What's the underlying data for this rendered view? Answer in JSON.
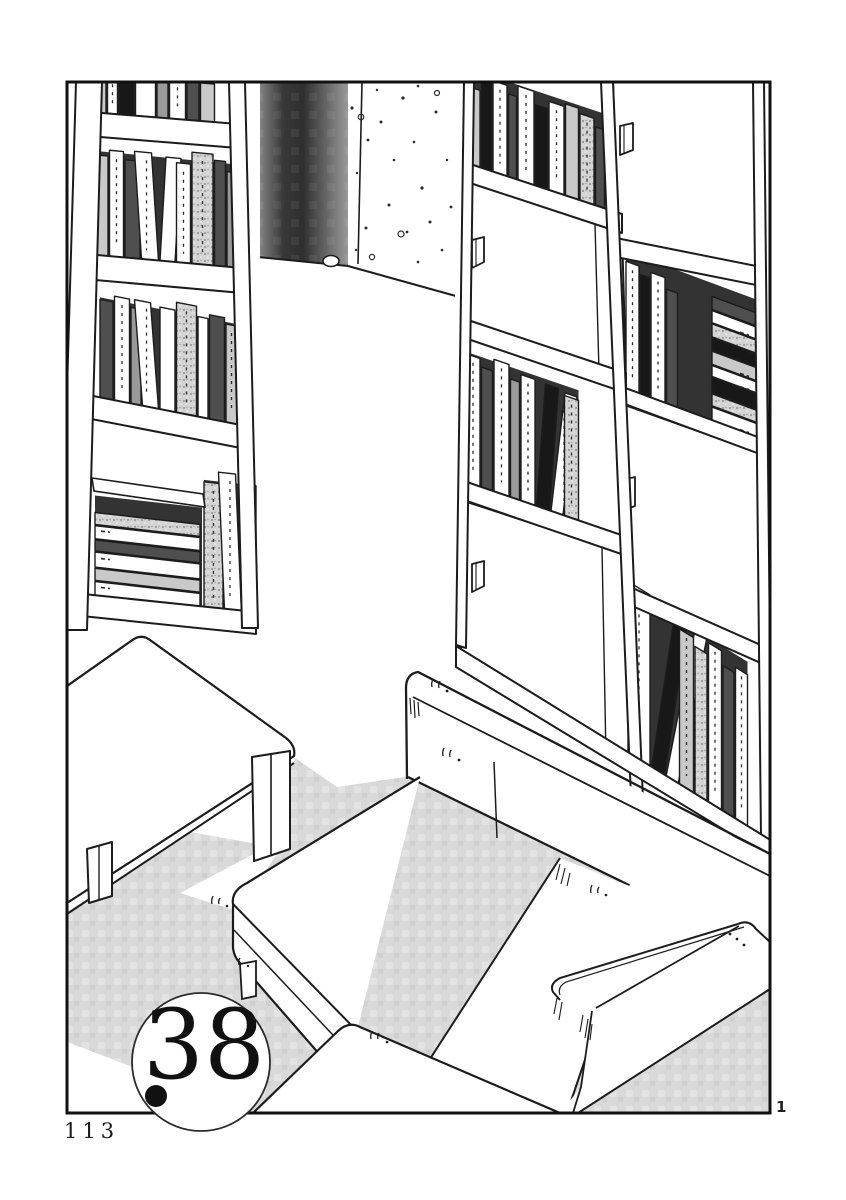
{
  "page": {
    "page_number": "113",
    "panel_number": "1",
    "chapter_badge": "38"
  },
  "colors": {
    "ink": "#1c1c1c",
    "paper": "#ffffff",
    "screentone": "#d9d9d9",
    "wall_shadow_dark": "#2f2f2f",
    "book_dark": "#181818",
    "book_gray": "#c9c9c9"
  },
  "scene": {
    "left_shelf": {
      "rows": [
        {
          "bx": 92,
          "by": 112,
          "slope": 0.082,
          "x": 94,
          "shadow": 46,
          "books": [
            [
              12,
              40,
              "lg",
              0,
              ""
            ],
            [
              10,
              46,
              "w",
              0,
              "m"
            ],
            [
              15,
              42,
              "bk",
              0,
              ""
            ],
            [
              20,
              38,
              "w",
              0,
              ""
            ],
            [
              11,
              44,
              "mg",
              0,
              ""
            ],
            [
              16,
              40,
              "w",
              0,
              "m"
            ],
            [
              12,
              46,
              "dg",
              0,
              ""
            ],
            [
              14,
              38,
              "lg",
              0,
              ""
            ]
          ]
        },
        {
          "bx": 86,
          "by": 254,
          "slope": 0.096,
          "x": 96,
          "shadow": 104,
          "books": [
            [
              12,
              100,
              "lg",
              0,
              ""
            ],
            [
              14,
              106,
              "w",
              0,
              "m"
            ],
            [
              15,
              98,
              "dg",
              0,
              ""
            ],
            [
              17,
              108,
              "w",
              -7,
              "m"
            ],
            [
              15,
              104,
              "w",
              6,
              ""
            ],
            [
              14,
              100,
              "w",
              0,
              "m"
            ],
            [
              21,
              112,
              "tx",
              0,
              "m"
            ],
            [
              11,
              106,
              "dg",
              0,
              ""
            ],
            [
              10,
              96,
              "mg",
              0,
              ""
            ]
          ]
        },
        {
          "bx": 83,
          "by": 394,
          "slope": 0.196,
          "x": 100,
          "shadow": 100,
          "books": [
            [
              13,
              98,
              "dg",
              0,
              ""
            ],
            [
              15,
              104,
              "w",
              0,
              "m"
            ],
            [
              10,
              96,
              "mg",
              0,
              ""
            ],
            [
              16,
              106,
              "w",
              -8,
              "m"
            ],
            [
              15,
              102,
              "w",
              0,
              ""
            ],
            [
              20,
              110,
              "tx",
              0,
              "m"
            ],
            [
              10,
              100,
              "w",
              0,
              ""
            ],
            [
              15,
              104,
              "dg",
              0,
              ""
            ],
            [
              11,
              98,
              "lg",
              0,
              "m"
            ]
          ]
        },
        {
          "bx": 64,
          "by": 592,
          "slope": 0.113,
          "x": 66,
          "shadow": 0,
          "books": [
            [
              13,
              122,
              "bk",
              0,
              ""
            ]
          ]
        },
        {
          "bx": 64,
          "by": 592,
          "slope": 0.113,
          "x": 95,
          "span": 107,
          "shadow": 100,
          "books": []
        },
        {
          "bx": 64,
          "by": 592,
          "slope": 0.113,
          "x": 204,
          "shadow": 128,
          "books": [
            [
              19,
              126,
              "tx",
              0,
              "m"
            ],
            [
              17,
              138,
              "w",
              -6,
              "m"
            ],
            [
              13,
              128,
              "dg",
              0,
              ""
            ]
          ]
        }
      ],
      "stacks": [
        {
          "x1": 95,
          "x2": 200,
          "bx": 64,
          "by": 592,
          "slope": 0.113,
          "side": "l",
          "slabs": [
            [
              14,
              "w",
              "m"
            ],
            [
              12,
              "lg",
              ""
            ],
            [
              15,
              "w",
              "m"
            ],
            [
              11,
              "dg",
              ""
            ],
            [
              13,
              "w",
              "m"
            ],
            [
              12,
              "tx",
              ""
            ]
          ]
        }
      ]
    },
    "right_shelf": {
      "rows": [
        {
          "bx": 464,
          "by": 163,
          "slope": 0.333,
          "x": 468,
          "shadow": 96,
          "books": [
            [
              12,
              78,
              "lg",
              0,
              ""
            ],
            [
              10,
              88,
              "bk",
              0,
              ""
            ],
            [
              14,
              92,
              "w",
              0,
              "m"
            ],
            [
              8,
              84,
              "dg",
              0,
              ""
            ],
            [
              16,
              95,
              "w",
              0,
              "m"
            ],
            [
              12,
              82,
              "bk",
              0,
              ""
            ],
            [
              15,
              90,
              "w",
              0,
              "m"
            ],
            [
              13,
              93,
              "lg",
              0,
              ""
            ],
            [
              14,
              88,
              "tx",
              0,
              "m"
            ],
            [
              9,
              80,
              "dg",
              0,
              ""
            ]
          ]
        },
        {
          "bx": 461,
          "by": 480,
          "slope": 0.343,
          "x": 466,
          "shadow": 130,
          "books": [
            [
              14,
              128,
              "w",
              0,
              "m"
            ],
            [
              11,
              120,
              "dg",
              0,
              ""
            ],
            [
              15,
              132,
              "w",
              0,
              "m"
            ],
            [
              9,
              118,
              "mg",
              0,
              ""
            ],
            [
              14,
              126,
              "w",
              0,
              "m"
            ],
            [
              13,
              122,
              "bk",
              9,
              ""
            ],
            [
              12,
              118,
              "w",
              14,
              "m"
            ],
            [
              14,
              120,
              "tx",
              0,
              "m"
            ]
          ]
        },
        {
          "bx": 620,
          "by": 387,
          "slope": 0.37,
          "x": 626,
          "span": 131,
          "shadow": 138,
          "books": [
            [
              13,
              128,
              "w",
              0,
              "m"
            ],
            [
              9,
              120,
              "bk",
              0,
              ""
            ],
            [
              14,
              126,
              "w",
              0,
              "m"
            ],
            [
              11,
              115,
              "dg",
              0,
              ""
            ]
          ]
        },
        {
          "bx": 456,
          "by": 648,
          "slope": 0.613,
          "x": 628,
          "shadow": 165,
          "books": [
            [
              22,
              172,
              "w",
              0,
              "m"
            ],
            [
              13,
              158,
              "bk",
              24,
              ""
            ],
            [
              12,
              152,
              "w",
              30,
              "m"
            ],
            [
              14,
              156,
              "lg",
              0,
              "m"
            ],
            [
              12,
              148,
              "tx",
              0,
              ""
            ],
            [
              13,
              160,
              "w",
              0,
              "m"
            ],
            [
              11,
              146,
              "dg",
              0,
              ""
            ],
            [
              12,
              152,
              "w",
              0,
              "m"
            ]
          ]
        }
      ],
      "stacks": [
        {
          "x1": 712,
          "x2": 757,
          "bx": 620,
          "by": 387,
          "slope": 0.37,
          "side": "r",
          "slabs": [
            [
              14,
              "w",
              "m"
            ],
            [
              12,
              "tx",
              ""
            ],
            [
              15,
              "bk",
              ""
            ],
            [
              11,
              "w",
              "m"
            ],
            [
              13,
              "lg",
              "m"
            ],
            [
              12,
              "bk",
              ""
            ],
            [
              13,
              "tx",
              ""
            ],
            [
              12,
              "w",
              "m"
            ],
            [
              13,
              "dg",
              ""
            ]
          ]
        }
      ]
    }
  }
}
